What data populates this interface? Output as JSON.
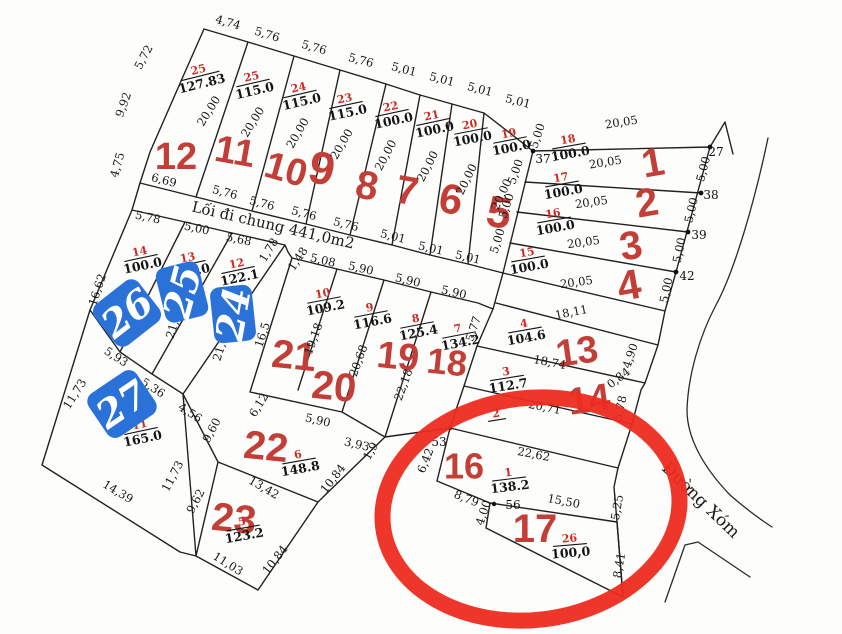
{
  "labels": {
    "common_path": "Lối đi chung 441,0m2",
    "road": "Đường Xóm"
  },
  "colors": {
    "plot_number_red": "#c23e37",
    "parcel_number_red": "#ce2a23",
    "stamp_blue": "#2b72d8",
    "highlight_circle_red": "#ee2b1f",
    "line_black": "#212121"
  },
  "big_numbers": [
    "12",
    "11",
    "10",
    "9",
    "8",
    "7",
    "6",
    "5",
    "1",
    "2",
    "3",
    "4",
    "13",
    "14",
    "16",
    "17",
    "18",
    "19",
    "20",
    "21",
    "22",
    "23"
  ],
  "parcels": [
    {
      "num": "25",
      "area": "127.83"
    },
    {
      "num": "25",
      "area": "115.0"
    },
    {
      "num": "24",
      "area": "115.0"
    },
    {
      "num": "23",
      "area": "115.0"
    },
    {
      "num": "22",
      "area": "100.0"
    },
    {
      "num": "21",
      "area": "100.0"
    },
    {
      "num": "20",
      "area": "100.0"
    },
    {
      "num": "19",
      "area": "100.0"
    },
    {
      "num": "18",
      "area": "100.0"
    },
    {
      "num": "17",
      "area": "100.0"
    },
    {
      "num": "16",
      "area": "100.0"
    },
    {
      "num": "15",
      "area": "100.0"
    },
    {
      "num": "14",
      "area": "100.0"
    },
    {
      "num": "13",
      "area": "100.0"
    },
    {
      "num": "12",
      "area": "122.1"
    },
    {
      "num": "10",
      "area": "109.2"
    },
    {
      "num": "9",
      "area": "116.6"
    },
    {
      "num": "8",
      "area": "125.4"
    },
    {
      "num": "7",
      "area": "134.2"
    },
    {
      "num": "4",
      "area": "104.6"
    },
    {
      "num": "3",
      "area": "112.7"
    },
    {
      "num": "2",
      "area": ""
    },
    {
      "num": "1",
      "area": "138.2"
    },
    {
      "num": "26",
      "area": "100,0"
    },
    {
      "num": "11",
      "area": "165.0"
    },
    {
      "num": "6",
      "area": "148.8"
    },
    {
      "num": "5",
      "area": "123.2"
    }
  ],
  "dims": [
    "4,74",
    "5,76",
    "5,76",
    "5,76",
    "5,01",
    "5,01",
    "5,01",
    "5,01",
    "5,00",
    "20,05",
    "20,05",
    "20,05",
    "20,05",
    "20,05",
    "18,11",
    "5,72",
    "9,92",
    "4,75",
    "6,69",
    "5,76",
    "5,76",
    "5,76",
    "5,76",
    "5,01",
    "5,01",
    "5,01",
    "20,00",
    "20,00",
    "20,00",
    "20,00",
    "20,00",
    "20,00",
    "20,00",
    "20,00",
    "5,00",
    "5,00",
    "5,00",
    "5,00",
    "5,00",
    "5,00",
    "5,00",
    "5,78",
    "5,00",
    "5,68",
    "1,78",
    "1,48",
    "5,08",
    "5,90",
    "5,90",
    "5,90",
    "16,62",
    "21,2",
    "21,73",
    "16,5",
    "19,18",
    "20,68",
    "22,18",
    "5,77",
    "11,73",
    "5,93",
    "5,36",
    "4,56",
    "9,60",
    "6,12",
    "14,39",
    "11,73",
    "9,62",
    "13,42",
    "10,84",
    "11,03",
    "10,84",
    "5,90",
    "3,93",
    "1,9",
    "6,42",
    "8,79",
    "4,00",
    "15,50",
    "22,62",
    "18,74",
    "20,71",
    "0,84",
    "4,90",
    "5,78",
    "5,25",
    "8,41"
  ],
  "markers": [
    "37",
    "27",
    "38",
    "39",
    "42",
    "53",
    "56"
  ],
  "stamps": [
    "26",
    "25",
    "24",
    "27"
  ]
}
